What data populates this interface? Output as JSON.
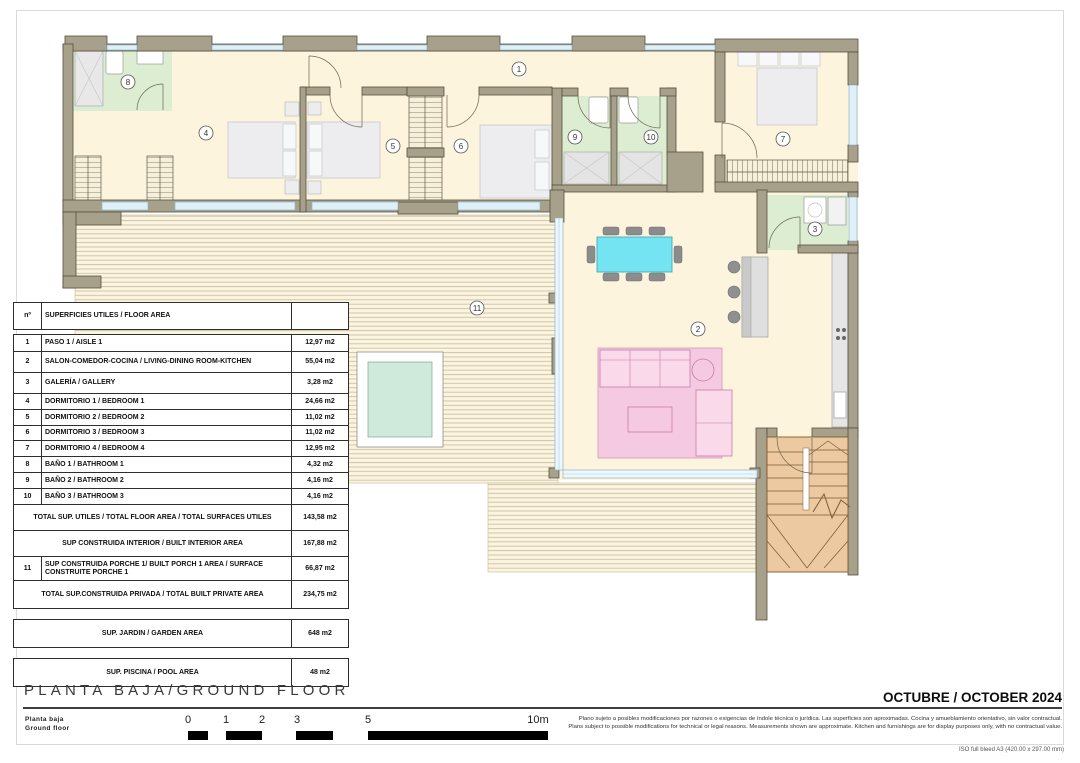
{
  "sheet": {
    "iso_note": "ISO full bleed A3 (420.00 x 297.00 mm)"
  },
  "title_block": {
    "title": "PLANTA BAJA/GROUND FLOOR",
    "date": "OCTUBRE / OCTOBER 2024",
    "floor_label_es": "Planta baja",
    "floor_label_en": "Ground floor",
    "disclaimer_line1": "Plano sujeto a posibles modificaciones por razones o exigencias de índole técnica o jurídica. Las superficies son aproximadas. Cocina y amueblamiento orientativo, sin valor contractual.",
    "disclaimer_line2": "Plans subject to possible modifications for technical or legal reasons. Measurements shown are approximate. Kitchen and furnishings are for display purposes only, with no contractual value."
  },
  "scale_bar": {
    "labels": [
      "0",
      "1",
      "2",
      "3",
      "5",
      "10m"
    ]
  },
  "area_table": {
    "header_num": "nº",
    "header_label": "SUPERFICIES UTILES / FLOOR AREA",
    "rows": [
      {
        "n": "1",
        "label": "PASO 1 / AISLE 1",
        "area": "12,97 m2"
      },
      {
        "n": "2",
        "label": "SALON-COMEDOR-COCINA /  LIVING-DINING ROOM-KITCHEN",
        "area": "55,04 m2"
      },
      {
        "n": "3",
        "label": "GALERÍA / GALLERY",
        "area": "3,28 m2"
      },
      {
        "n": "4",
        "label": "DORMITORIO 1 / BEDROOM 1",
        "area": "24,66 m2"
      },
      {
        "n": "5",
        "label": "DORMITORIO 2 / BEDROOM 2",
        "area": "11,02 m2"
      },
      {
        "n": "6",
        "label": "DORMITORIO 3 / BEDROOM 3",
        "area": "11,02 m2"
      },
      {
        "n": "7",
        "label": "DORMITORIO 4 / BEDROOM 4",
        "area": "12,95 m2"
      },
      {
        "n": "8",
        "label": "BAÑO 1 / BATHROOM 1",
        "area": "4,32 m2"
      },
      {
        "n": "9",
        "label": "BAÑO 2 / BATHROOM 2",
        "area": "4,16 m2"
      },
      {
        "n": "10",
        "label": "BAÑO 3 / BATHROOM 3",
        "area": "4,16 m2"
      }
    ],
    "total_utiles": {
      "label": "TOTAL SUP. UTILES / TOTAL FLOOR AREA / TOTAL SURFACES UTILES",
      "area": "143,58 m2"
    },
    "built_interior": {
      "label": "SUP CONSTRUIDA INTERIOR / BUILT INTERIOR AREA",
      "area": "167,88 m2"
    },
    "porch": {
      "n": "11",
      "label": "SUP CONSTRUIDA PORCHE 1/ BUILT PORCH 1 AREA / SURFACE CONSTRUITE PORCHE 1",
      "area": "66,87 m2"
    },
    "total_private": {
      "label": "TOTAL SUP.CONSTRUIDA PRIVADA / TOTAL  BUILT PRIVATE AREA",
      "area": "234,75 m2"
    },
    "garden": {
      "label": "SUP. JARDIN / GARDEN AREA",
      "area": "648 m2"
    },
    "pool": {
      "label": "SUP. PISCINA / POOL AREA",
      "area": "48 m2"
    }
  },
  "plan": {
    "room_numbers": [
      "1",
      "2",
      "3",
      "4",
      "5",
      "6",
      "7",
      "8",
      "9",
      "10",
      "11"
    ],
    "colors": {
      "wall": "#a7a08a",
      "floor": "#fdf4dd",
      "wet_room": "#dcedd2",
      "deck_line": "#ccc2a0",
      "pool_water": "#cfe9db",
      "stairs": "#ecc9a1",
      "rug": "#f6c9e2",
      "dining_table": "#74e3f2",
      "window": "#dff0f8"
    }
  }
}
